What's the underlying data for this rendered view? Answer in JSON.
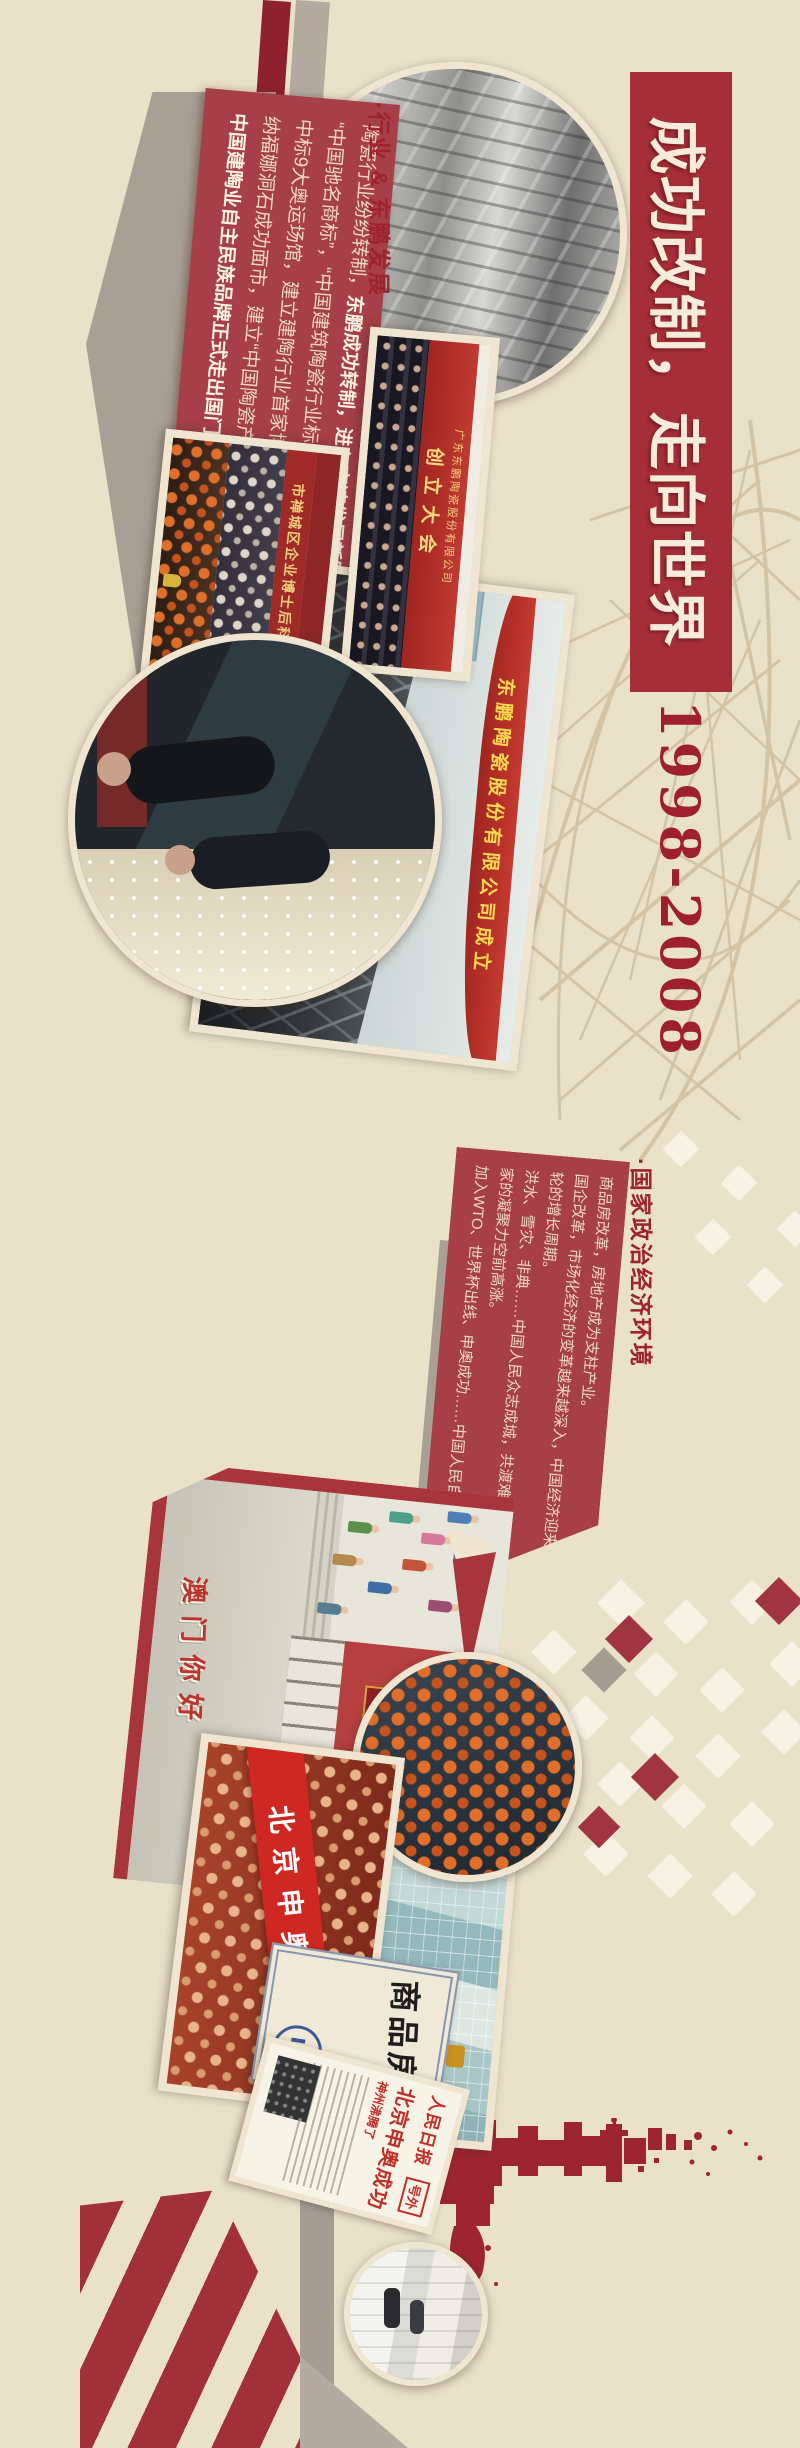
{
  "poster": {
    "title": "成功改制，走向世界",
    "period": "1998-2008"
  },
  "section_industry": {
    "header": "·行业 & 东鹏发展",
    "intro": "陶瓷行业纷纷转制，",
    "intro_bold": "东鹏成功转制，进入高速发展新阶段。",
    "lines": [
      "“中国驰名商标”，“中国建筑陶瓷行业标志性品牌”，",
      "中标9大奥运场馆，建立建陶行业首家博士后工作站，",
      "纳福娜洞石成功面市，建立“中国陶瓷产业驻欧领事馆”，"
    ],
    "closing_bold": "中国建陶业自主民族品牌正式走出国门。"
  },
  "section_environment": {
    "header": "·国家政治经济环境",
    "lines": [
      "商品房改革，房地产成为支柱产业。",
      "国企改革，市场化经济的变革越来越深入，中国经济迎来新一",
      "轮的增长周期。",
      "洪水、雪灾、非典……中国人民众志成城，共渡难关，一个国",
      "家的凝聚力空前高涨。",
      "加入WTO、世界杯出线、申奥成功……中国人民自信的走向世界。"
    ]
  },
  "photos": {
    "founding_congress": {
      "company": "广东东鹏陶瓷股份有限公司",
      "event": "创立大会"
    },
    "postdoc_station": {
      "banner": "市禅城区企业博士后科研工作站"
    },
    "birdsnest": {
      "banner": "东鹏陶瓷股份有限公司成立"
    },
    "macau_scene": {
      "sign_title": "中国政府",
      "sign_sub": "对澳门恢复行使主权",
      "street_text": "澳门你好"
    },
    "olympic_bid": {
      "banner": "北京申奥成功"
    },
    "commodity_housing_card": {
      "text": "商品房"
    },
    "newspaper": {
      "masthead": "人民日报",
      "edition": "号外",
      "headline": "北京申奥成功",
      "subhead": "神州沸腾了"
    }
  },
  "colors": {
    "background": "#eae1c9",
    "title_banner_red": "#a62e38",
    "text_block_red": "#a63f47",
    "dark_red_text": "#9e2230",
    "cream_text": "#eed8c3",
    "frame_cream": "#efe5d0",
    "splatter_red": "#9c2531",
    "diamond_red": "#a03440",
    "diamond_gray": "#a59d91",
    "diamond_white": "#f7f2e4"
  }
}
